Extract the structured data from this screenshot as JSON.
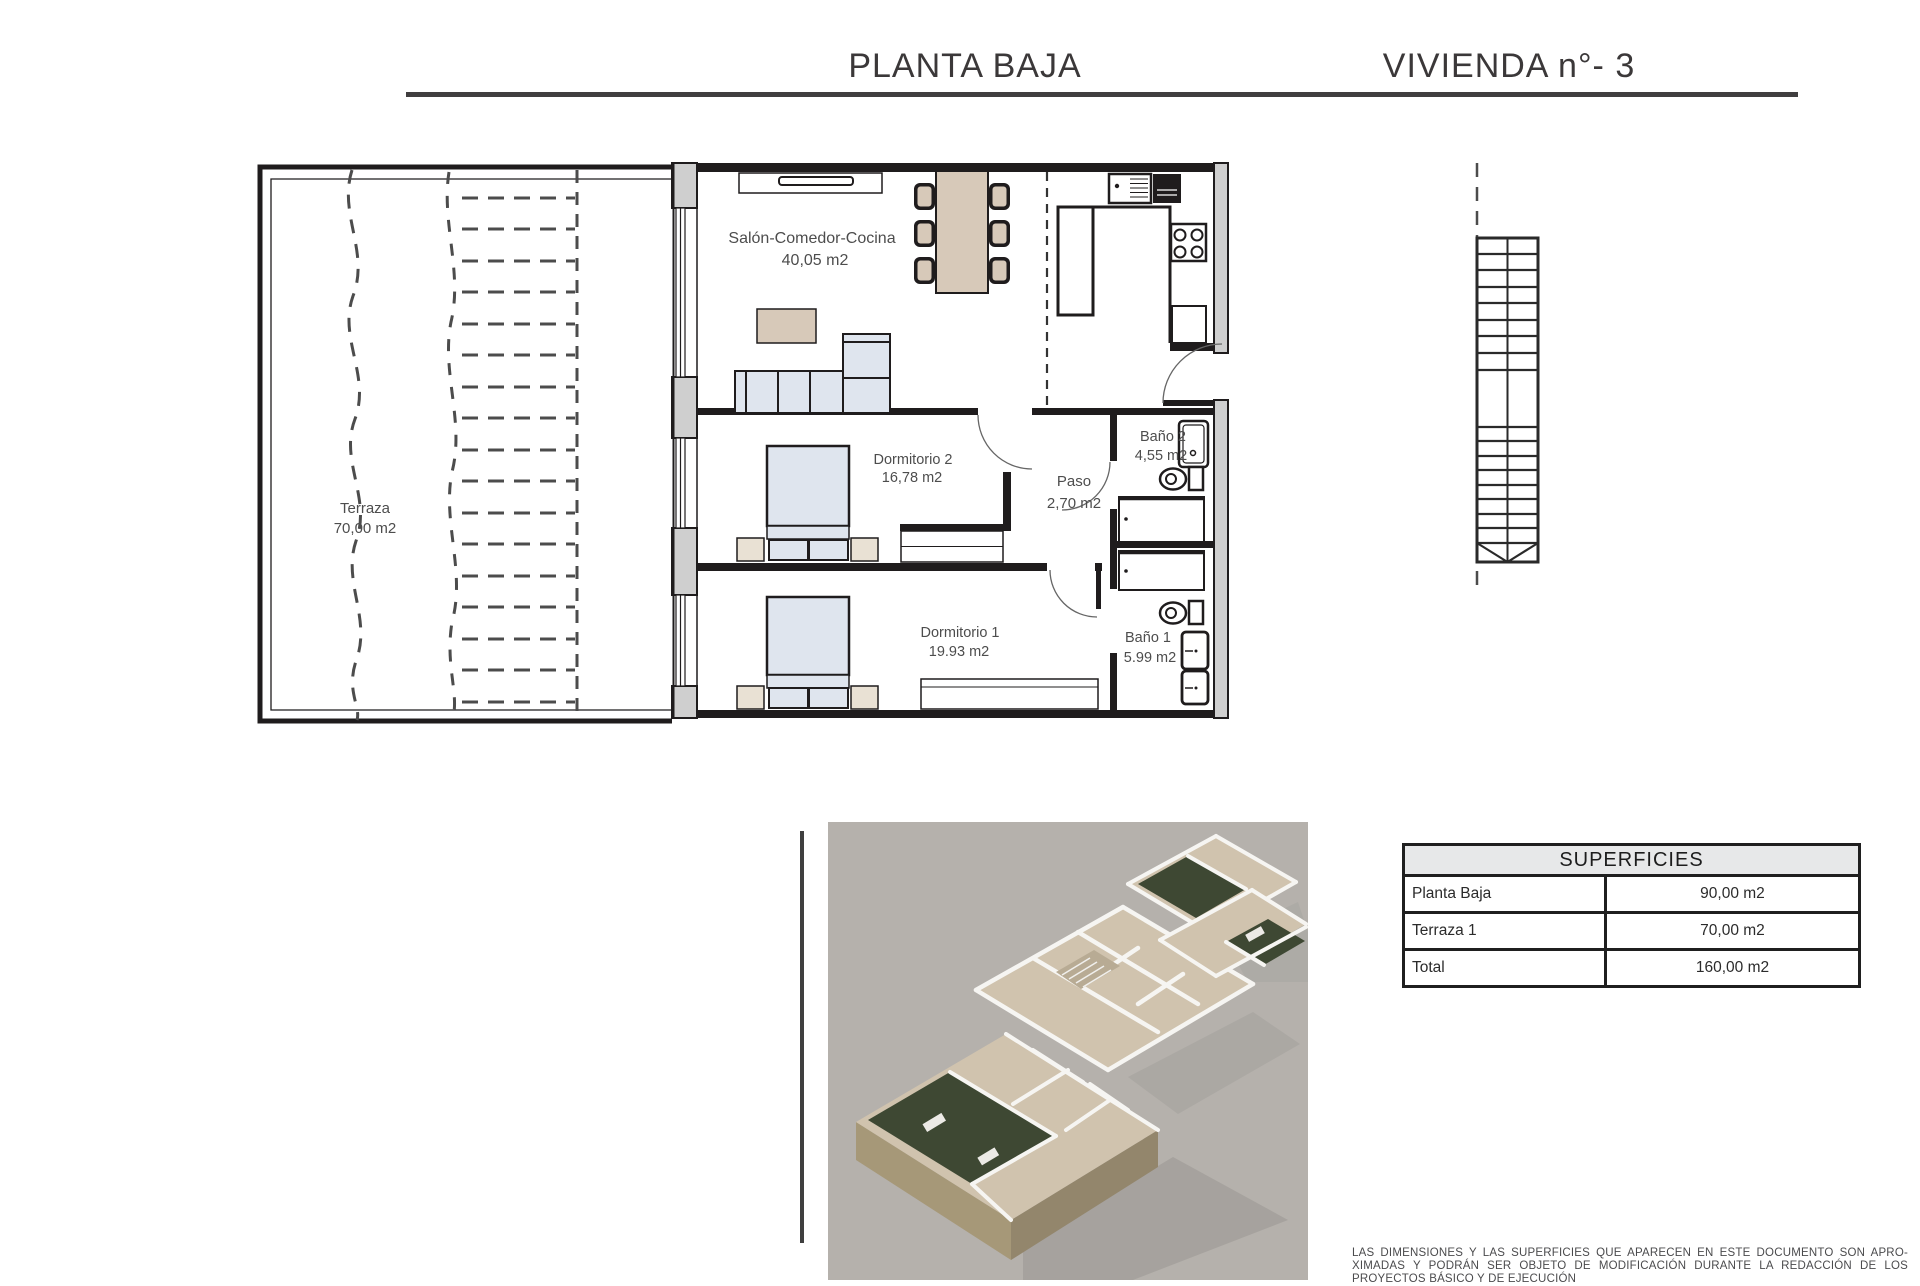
{
  "header": {
    "left_title": "PLANTA BAJA",
    "right_title": "VIVIENDA n°- 3"
  },
  "plan": {
    "rooms": {
      "salon": {
        "name": "Salón-Comedor-Cocina",
        "area": "40,05 m2"
      },
      "terraza": {
        "name": "Terraza",
        "area": "70,00 m2"
      },
      "dormitorio2": {
        "name": "Dormitorio 2",
        "area": "16,78 m2"
      },
      "paso": {
        "name": "Paso",
        "area": "2,70 m2"
      },
      "bano2": {
        "name": "Baño 2",
        "area": "4,55 m2"
      },
      "dormitorio1": {
        "name": "Dormitorio 1",
        "area": "19.93 m2"
      },
      "bano1": {
        "name": "Baño 1",
        "area": "5.99 m2"
      }
    }
  },
  "table": {
    "title": "SUPERFICIES",
    "rows": [
      {
        "label": "Planta Baja",
        "value": "90,00 m2"
      },
      {
        "label": "Terraza 1",
        "value": "70,00 m2"
      },
      {
        "label": "Total",
        "value": "160,00 m2"
      }
    ]
  },
  "disclaimer": {
    "lines": [
      "LAS DIMENSIONES Y LAS SUPERFICIES QUE APARECEN EN ESTE DOCUMENTO SON APRO-",
      "XIMADAS Y PODRÁN SER OBJETO DE MODIFICACIÓN DURANTE LA REDACCIÓN DE LOS",
      "PROYECTOS BÁSICO Y DE EJECUCIÓN"
    ]
  },
  "colors": {
    "wall": "#1f1c1d",
    "wall_poche": "#cfcfcf",
    "furniture_tan": "#d7c9b9",
    "furniture_blue": "#dfe5ee",
    "label_gray": "#4d4d4d",
    "rule_dark": "#403e3f",
    "table_header_bg": "#e7e8e9",
    "render_bg": "#b5b1ac",
    "render_floor": "#d0c3ae",
    "render_garden": "#3e4833",
    "render_stone": "#a69878"
  }
}
